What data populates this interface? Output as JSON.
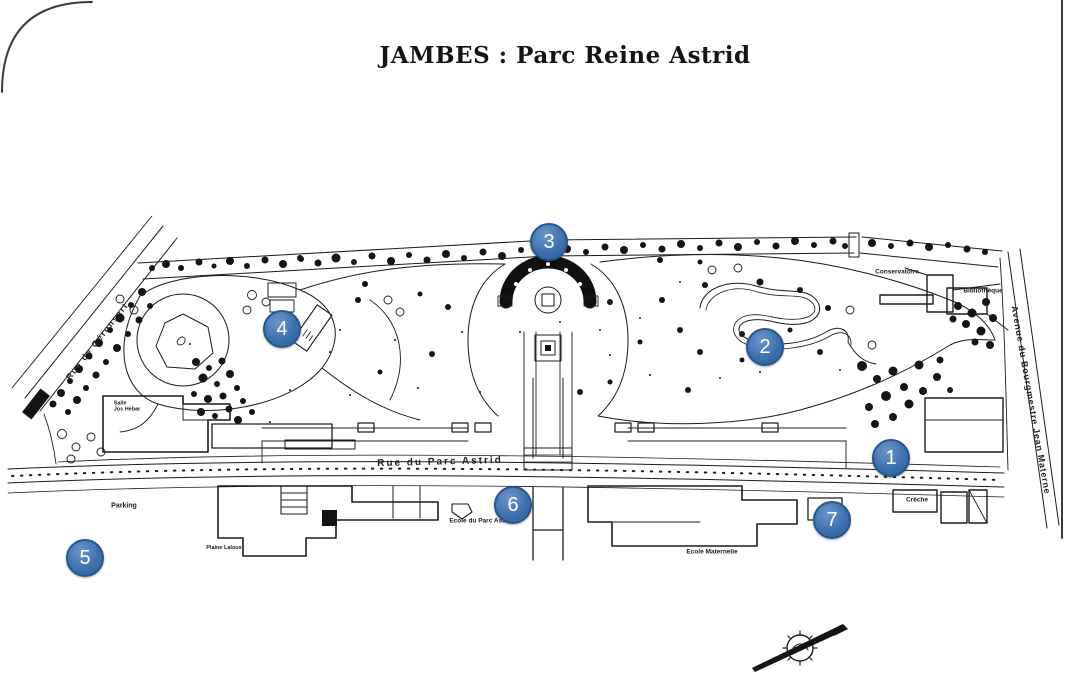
{
  "title": "JAMBES : Parc Reine Astrid",
  "streets": {
    "geronsart": "Rue de Géronsart",
    "parc_astrid": "Rue du Parc Astrid",
    "bourgmestre": "Avenue du Bourgmestre Jean Materne"
  },
  "places": {
    "parking": "Parking",
    "salle_line1": "Salle",
    "salle_line2": "Jos Hebar",
    "plaine": "Plaine Laloux",
    "ecole_parc": "Ecole du Parc Astrid",
    "ecole_maternelle": "Ecole Maternelle",
    "conservatoire": "Conservatoire",
    "bibliotheque": "Bibliothèque",
    "creche": "Crèche"
  },
  "markers": [
    {
      "number": "1"
    },
    {
      "number": "2"
    },
    {
      "number": "3"
    },
    {
      "number": "4"
    },
    {
      "number": "5"
    },
    {
      "number": "6"
    },
    {
      "number": "7"
    }
  ],
  "colors": {
    "marker_fill": "#3e71af",
    "marker_border": "#275590",
    "marker_text": "#ffffff",
    "map_ink": "#1c1c1c",
    "background": "#ffffff"
  }
}
